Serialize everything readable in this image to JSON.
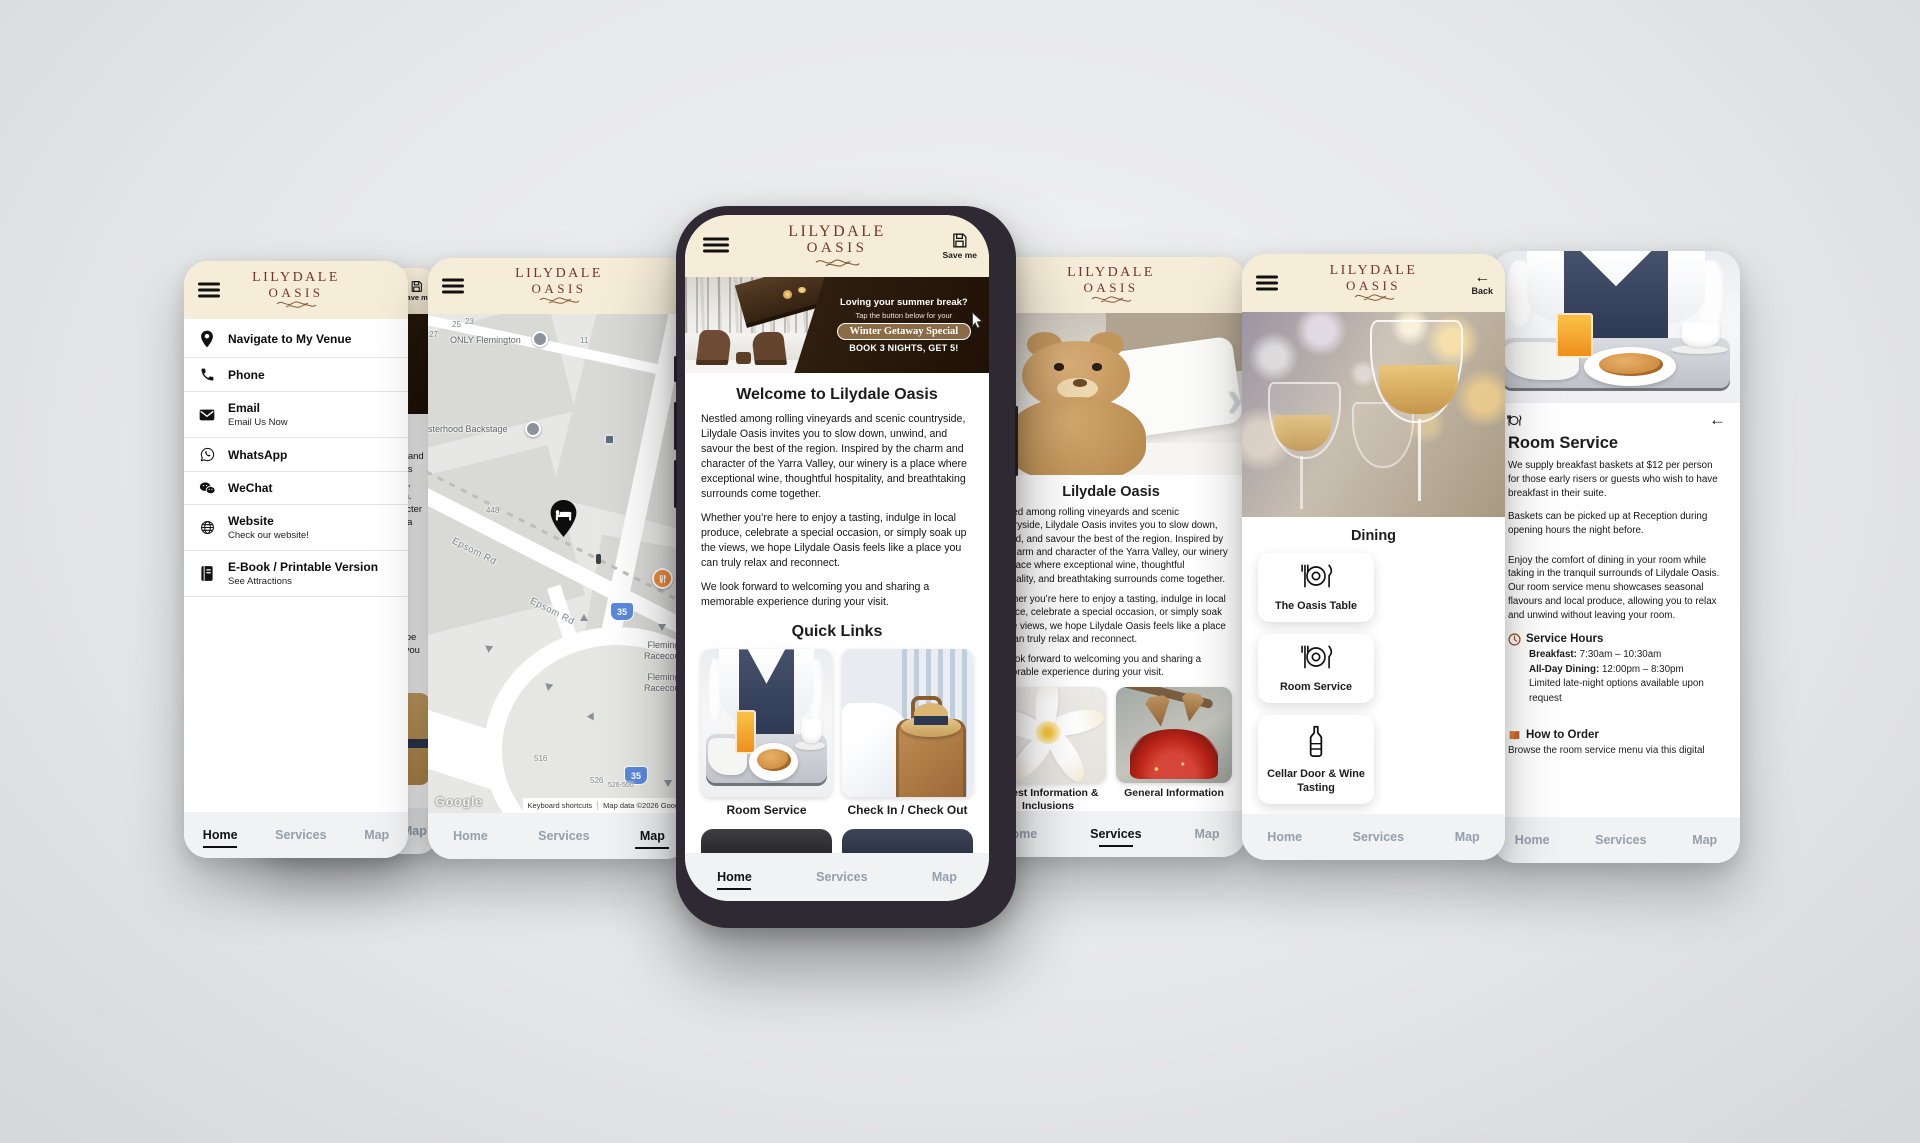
{
  "brand": {
    "line1": "LILYDALE",
    "line2": "OASIS"
  },
  "nav": {
    "home": "Home",
    "services": "Services",
    "map": "Map"
  },
  "chrome": {
    "save_me": "Save me",
    "back": "Back"
  },
  "menu": {
    "items": [
      {
        "label": "Navigate to My Venue",
        "sub": ""
      },
      {
        "label": "Phone",
        "sub": ""
      },
      {
        "label": "Email",
        "sub": "Email Us Now"
      },
      {
        "label": "WhatsApp",
        "sub": ""
      },
      {
        "label": "WeChat",
        "sub": ""
      },
      {
        "label": "Website",
        "sub": "Check our website!"
      },
      {
        "label": "E-Book / Printable Version",
        "sub": "See Attractions"
      }
    ]
  },
  "map": {
    "poi_only_flemington": "ONLY Flemington",
    "poi_sisterhood": "Sisterhood Backstage",
    "road_epsom": "Epsom Rd",
    "racecourse": "Flemington Racecourse",
    "route_shield": "35",
    "n23": "23",
    "n25": "25",
    "n27": "27",
    "n11": "11",
    "n448": "448",
    "n516": "516",
    "n526": "526",
    "n526550": "526-550",
    "google": "Google",
    "keyboard_shortcuts": "Keyboard shortcuts",
    "attribution": "Map data ©2026 Google"
  },
  "home": {
    "banner_line1": "Loving your summer break?",
    "banner_line2": "Tap the button below for your",
    "banner_button": "Winter Getaway Special",
    "banner_line3": "BOOK 3 NIGHTS, GET 5!",
    "welcome_title": "Welcome to Lilydale Oasis",
    "about_title": "Lilydale Oasis",
    "p1": "Nestled among rolling vineyards and scenic countryside, Lilydale Oasis invites you to slow down, unwind, and savour the best of the region. Inspired by the charm and character of the Yarra Valley, our winery is a place where exceptional wine, thoughtful hospitality, and breathtaking surrounds come together.",
    "p2": "Whether you’re here to enjoy a tasting, indulge in local produce, celebrate a special occasion, or simply soak up the views, we hope Lilydale Oasis feels like a place you can truly relax and reconnect.",
    "p3": "We look forward to welcoming you and sharing a memorable experience during your visit.",
    "quick_links_title": "Quick Links",
    "card_room_service": "Room Service",
    "card_check": "Check In / Check Out"
  },
  "services": {
    "card_guest_info": "Guest Information & Inclusions",
    "card_general_info": "General Information"
  },
  "dining": {
    "title": "Dining",
    "card_oasis_table": "The Oasis Table",
    "card_room_service": "Room Service",
    "card_cellar": "Cellar Door & Wine Tasting"
  },
  "room_service": {
    "title": "Room Service",
    "p1": "We supply breakfast baskets at $12 per person for those early risers or guests who wish to have breakfast in their suite.",
    "p2": "Baskets can be picked up at Reception during opening hours the night before.",
    "p3": "Enjoy the comfort of dining in your room while taking in the tranquil surrounds of Lilydale Oasis. Our room service menu showcases seasonal flavours and local produce, allowing you to relax and unwind without leaving your room.",
    "hours_title": "Service Hours",
    "breakfast_label": "Breakfast:",
    "breakfast_value": " 7:30am – 10:30am",
    "allday_label": "All-Day Dining:",
    "allday_value": " 12:00pm – 8:30pm",
    "hours_note": "Limited late-night options available upon request",
    "order_title": "How to Order",
    "order_text": "Browse the room service menu via this digital"
  },
  "colors": {
    "header_bg": "#f6edd8",
    "brand": "#74352a",
    "banner_brown": "#2a1a0c",
    "nav_inactive": "#93a0ad"
  }
}
